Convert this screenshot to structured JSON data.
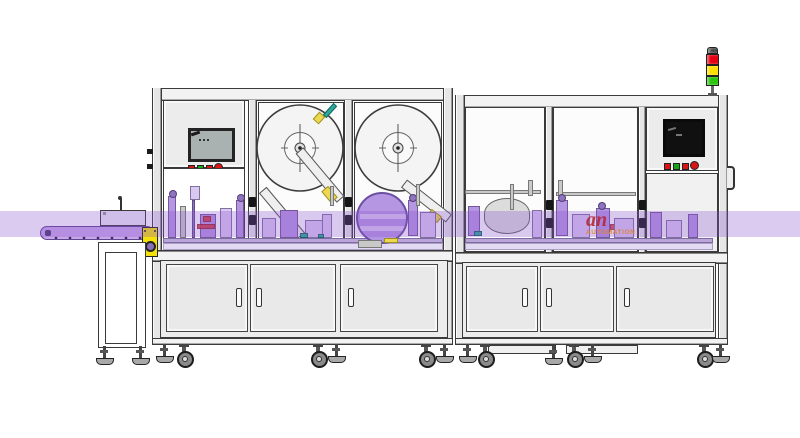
{
  "meta": {
    "type": "technical-illustration",
    "subject": "Automatic labeling and packaging machine line, side elevation drawing"
  },
  "watermark": {
    "brand_fragment": "an",
    "caption": "AUTOMATION"
  },
  "signal_tower": {
    "lights": [
      "red",
      "yellow",
      "green"
    ]
  },
  "hmi_left": {
    "screen": "touchscreen",
    "buttons": [
      "red",
      "green",
      "red",
      "red-round"
    ]
  },
  "hmi_right": {
    "screen": "touchscreen-dark",
    "buttons": [
      "red",
      "green",
      "red",
      "red-round"
    ]
  },
  "colors": {
    "line": "#3a3a3a",
    "panel": "#ececec",
    "window": "#fcfcfc",
    "beam": "#f2f2f2",
    "door": "#e9e9e9",
    "band": "rgba(139,84,209,0.30)",
    "belt": "#c7a6e8",
    "belt_line": "#5f4693",
    "motor_yellow": "#f4e10a",
    "sig_red": "#e60012",
    "sig_yellow": "#ffdf00",
    "sig_green": "#2bc40f",
    "sig_cap": "#4c4c4c",
    "btn_red": "#d81414",
    "btn_green": "#17a517",
    "scr_left": "#a9b2b0",
    "scr_dark": "#101010",
    "m1": "#b596e3",
    "m2": "#d8c9f1",
    "m3": "#8f74bf",
    "mg": "#c9c9c9",
    "mt": "#2ea79b",
    "mr": "#cf3434",
    "my": "#ecd94f",
    "wm_red": "#b5222b",
    "wm_orange": "#e2811d"
  }
}
